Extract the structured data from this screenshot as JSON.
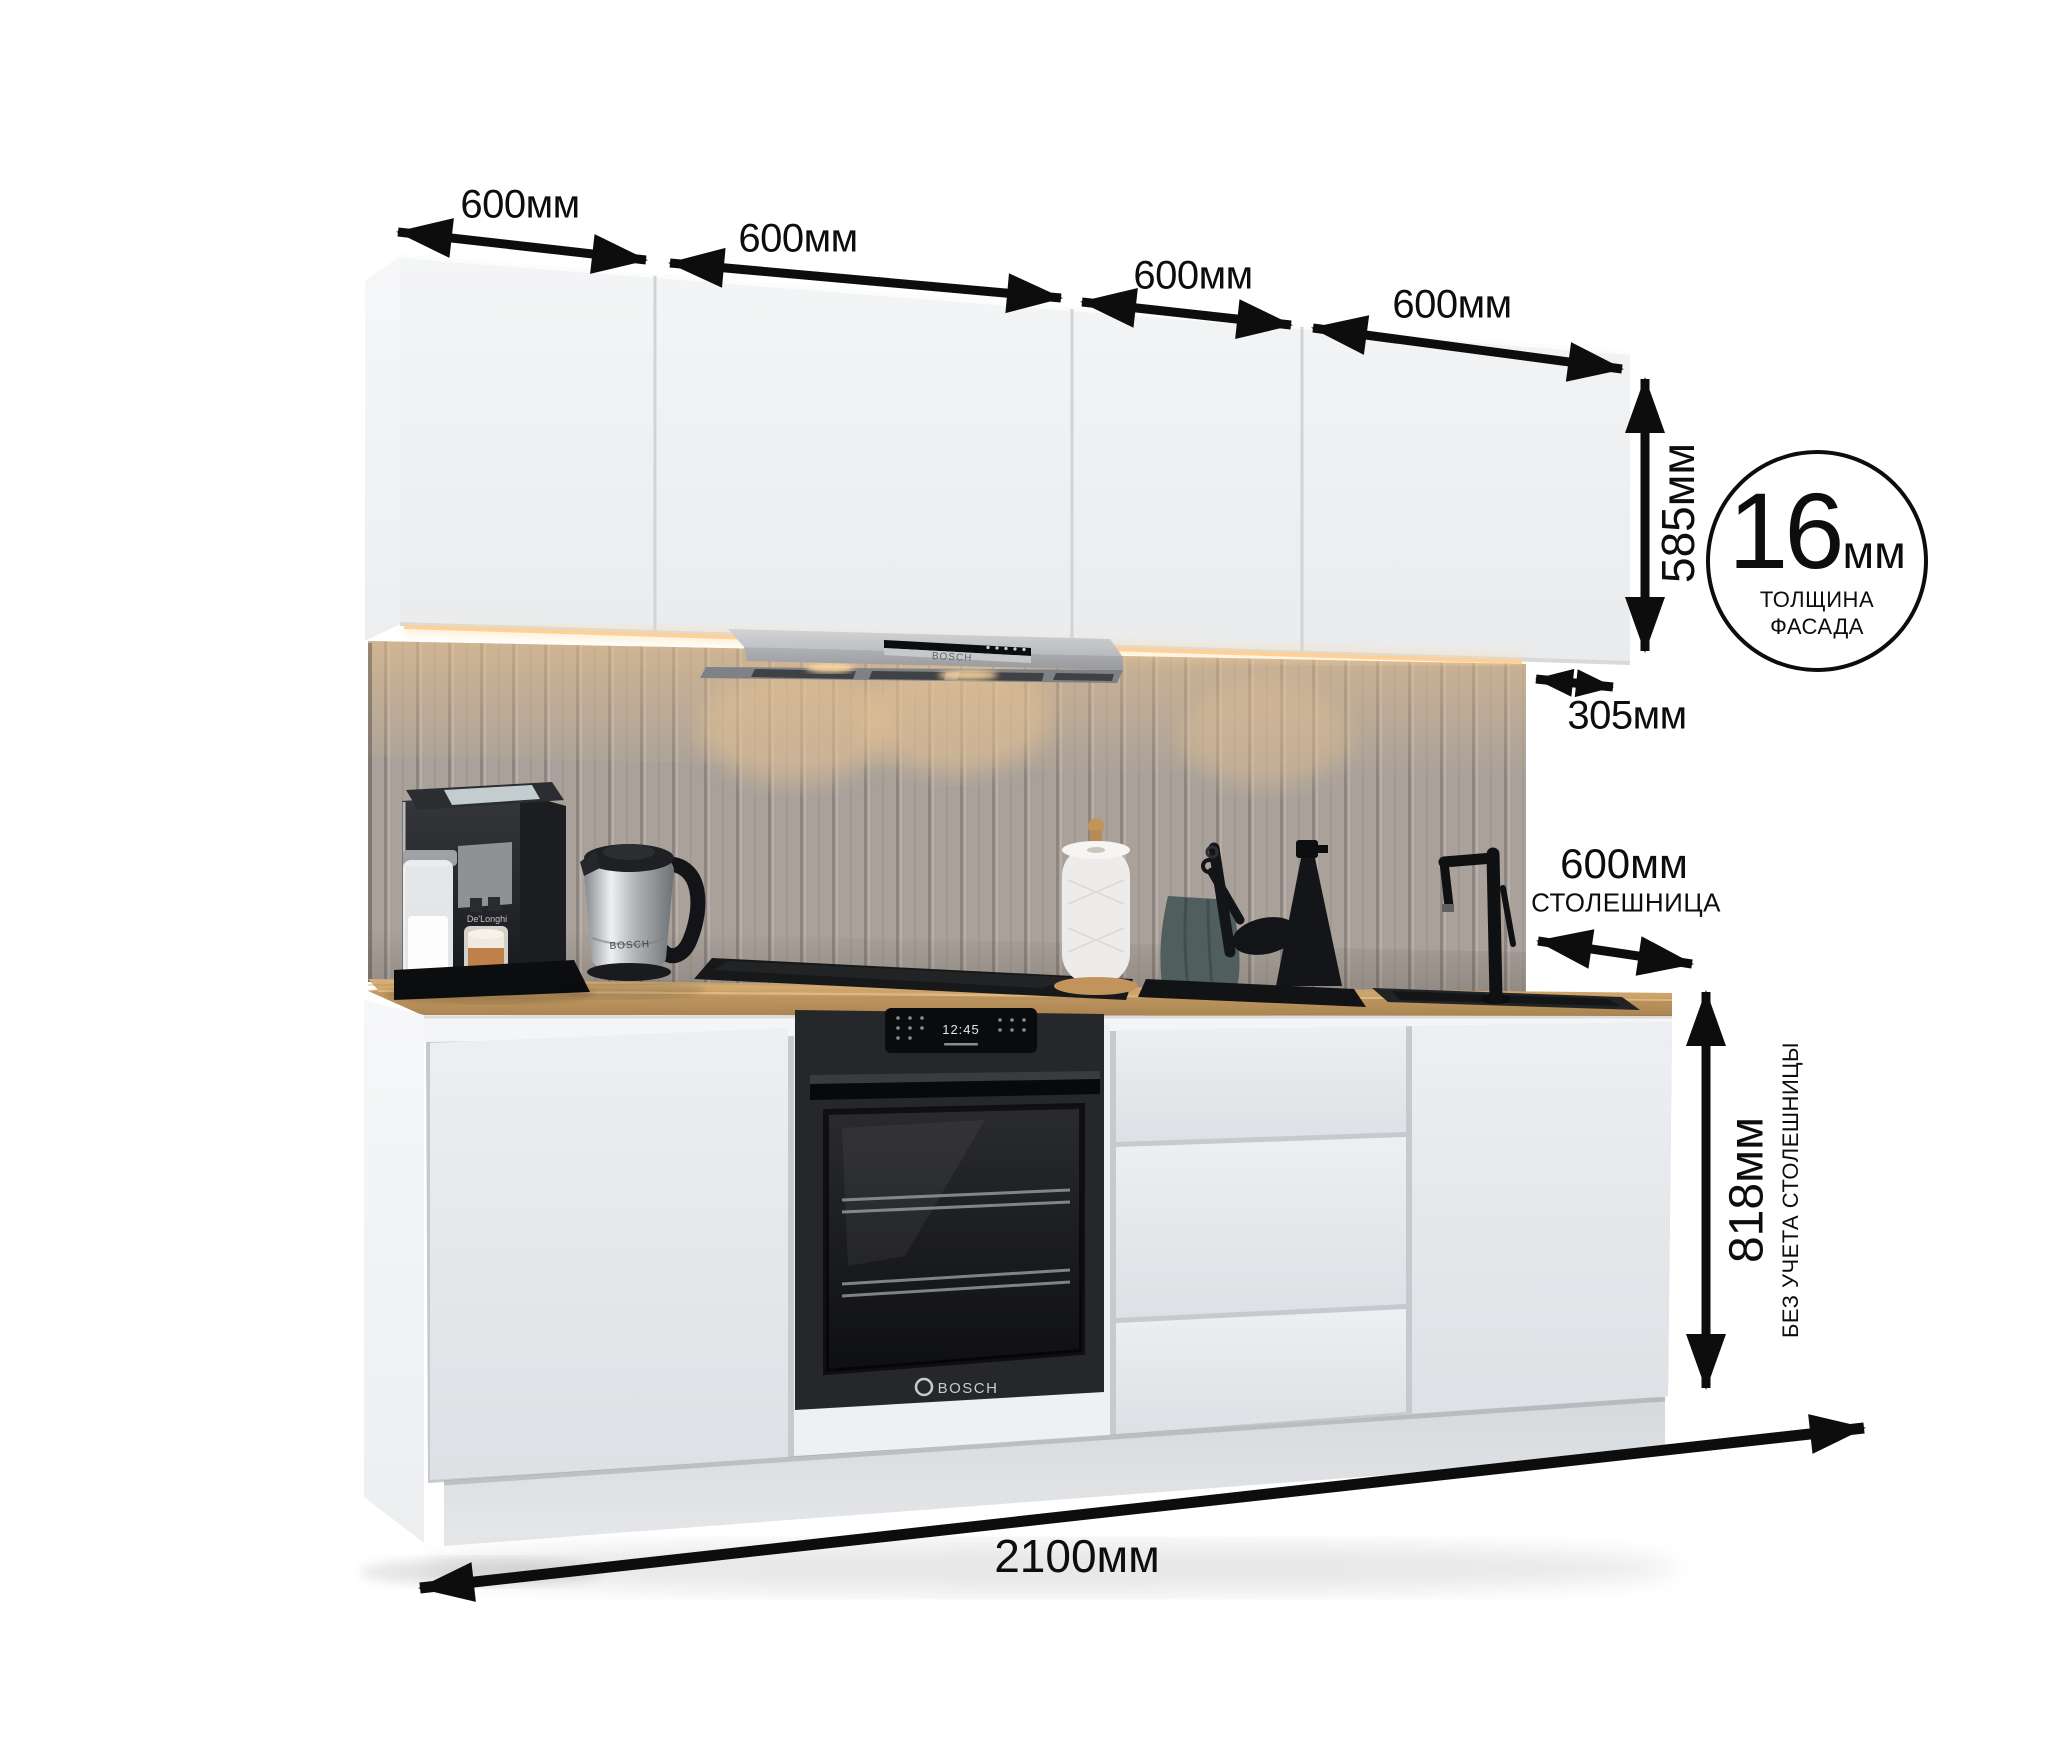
{
  "annotations": {
    "top_dims": [
      {
        "label": "600мм"
      },
      {
        "label": "600мм"
      },
      {
        "label": "600мм"
      },
      {
        "label": "600мм"
      }
    ],
    "upper_height": "585мм",
    "upper_depth": "305мм",
    "facade_badge": {
      "value": "16",
      "unit": "мм",
      "caption_line1": "ТОЛЩИНА",
      "caption_line2": "ФАСАДА"
    },
    "countertop_depth": {
      "value": "600мм",
      "caption": "СТОЛЕШНИЦА"
    },
    "base_height": {
      "value": "818мм",
      "caption": "БЕЗ УЧЕТА СТОЛЕШНИЦЫ"
    },
    "total_width": "2100мм"
  },
  "appliances": {
    "hood_brand": "BOSCH",
    "oven_brand": "BOSCH",
    "oven_clock": "12:45",
    "kettle_brand": "BOSCH",
    "coffee_machine_brand": "De'Longhi"
  },
  "colors": {
    "annotation": "#0d0d0d",
    "countertop_wood": "#cda76e",
    "backsplash": "#a9a19a",
    "cabinet_front": "#eceef1",
    "hood_silver": "#b4b6b9",
    "appliance_black": "#1b1c1e",
    "led_glow": "#ffd9a0"
  }
}
